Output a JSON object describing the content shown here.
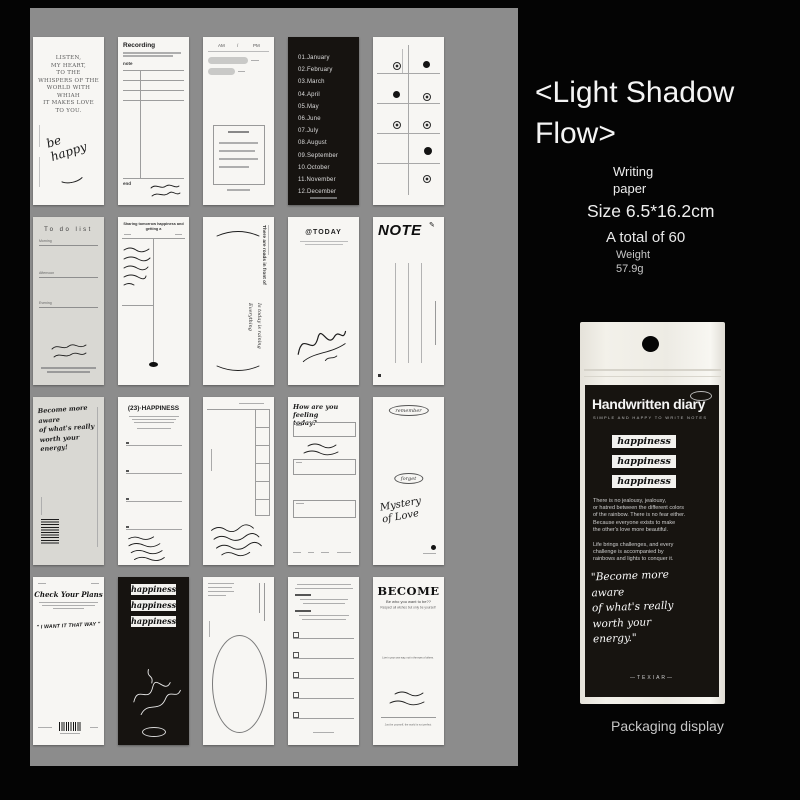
{
  "info": {
    "title": "<Light Shadow\nFlow>",
    "category": "Writing\npaper",
    "size": "Size 6.5*16.2cm",
    "total": "A total of 60",
    "weight": "Weight\n57.9g"
  },
  "cards": {
    "listen": {
      "lines": "LISTEN,\nMY HEART,\nTO THE\nWHISPERS OF THE\nWORLD WITH\nWHIAH\nIT MAKES LOVE\nTO YOU.",
      "handwriting": "be\nhappy"
    },
    "recording": {
      "title": "Recording",
      "note_label": "note",
      "end_label": "end"
    },
    "schedule": {
      "am": "AM",
      "slash": "/",
      "pm": "PM"
    },
    "months": {
      "list": "01.January\n02.February\n03.March\n04.April\n05.May\n06.June\n07.July\n08.August\n09.September\n10.October\n11.November\n12.December"
    },
    "todolist": {
      "title": "To do list",
      "label1": "Morning",
      "label2": "Afternoon",
      "label3": "Evening"
    },
    "tomorrow": {
      "header": "Sharing tomorrow happiness and getting a"
    },
    "roads": {
      "vertical_text": "There are roads in front of",
      "handwriting": "Is today is raining\nEverything"
    },
    "today": {
      "title": "@TODAY"
    },
    "note": {
      "title": "NOTE",
      "icon": "✎"
    },
    "become_gray": {
      "handwriting": "Become more\naware\nof what's really\nworth your\nenergy!"
    },
    "happiness_list": {
      "title": "(23)·HAPPINESS"
    },
    "feeling": {
      "title": "How are you feeling\ntoday?"
    },
    "remember": {
      "badge1": "remember",
      "badge2": "forget",
      "script": "Mystery\nof Love"
    },
    "checkplans": {
      "title": "Check Your Plans",
      "handwriting": "\" I WANT IT THAT WAY \""
    },
    "happiness_black": {
      "labels": [
        "happiness",
        "happiness",
        "happiness"
      ]
    },
    "become_white": {
      "title": "BECOME",
      "subtitle": "Be who you want to be??",
      "line3": "Respect all wishes but only be yourself",
      "midline": "Live in your own way, not in the eyes of others.",
      "footer": "Just be yourself, the world is not perfect"
    }
  },
  "packaging": {
    "brand": "Handwritten diary",
    "subtitle": "Simple and happy to write notes",
    "labels": [
      "happiness",
      "happiness",
      "happiness"
    ],
    "para1": "There is no jealousy, jealousy,\nor hatred between the different colors\nof the rainbow. There is no fear either.\nBecause everyone exists to make\nthe other's love more beautiful.",
    "para2": "Life brings challenges, and every\nchallenge  is accompanied by\nrainbows and lights to conquer it.",
    "quote": "\"Become more\naware\nof what's really\nworth your\nenergy.\"",
    "footer": "—TEXIAR—",
    "caption": "Packaging display"
  }
}
